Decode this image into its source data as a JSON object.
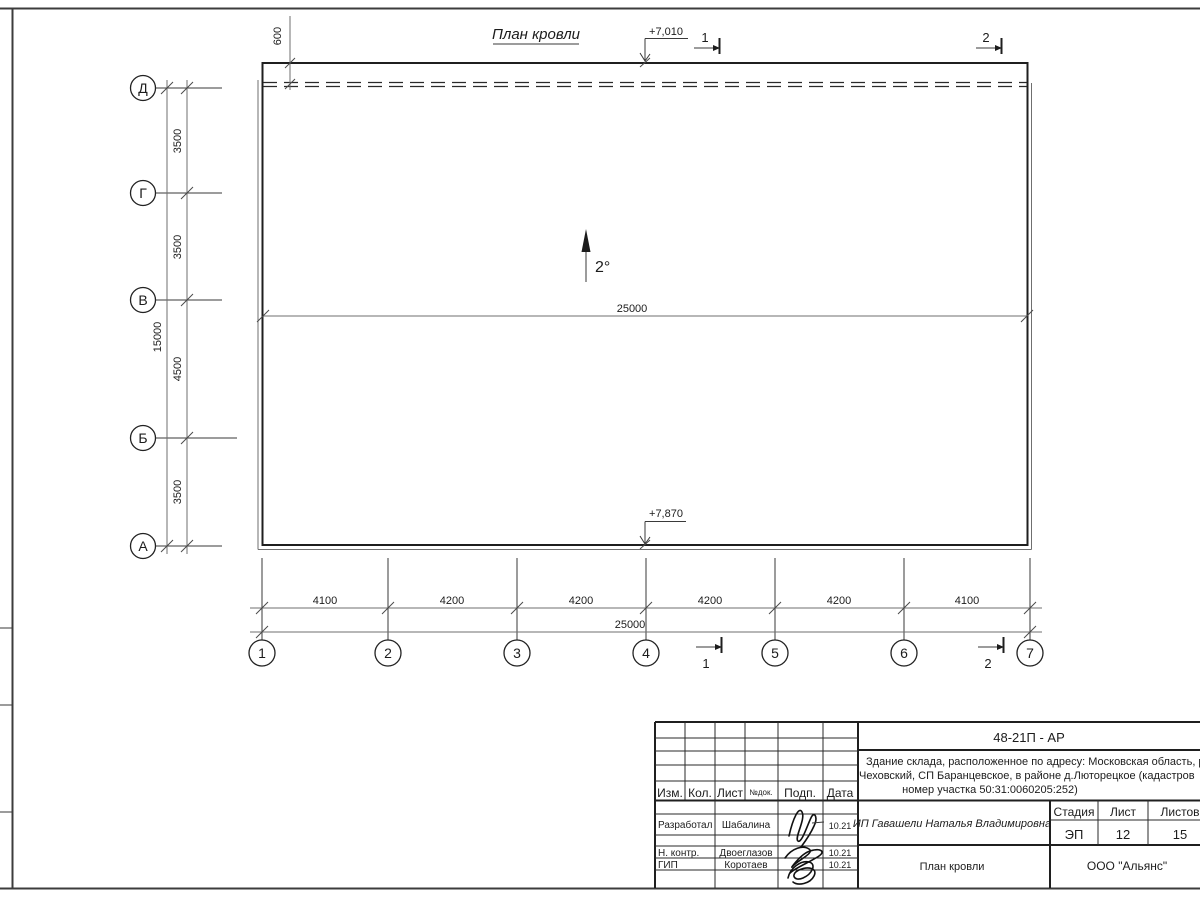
{
  "drawing": {
    "title": "План кровли",
    "slope_label": "2°",
    "elevation_top": "+7,010",
    "elevation_bottom": "+7,870",
    "ridge_length_label": "25000",
    "overhang_dim": "600"
  },
  "sections": {
    "one": "1",
    "two": "2"
  },
  "axes": {
    "vertical": [
      "Д",
      "Г",
      "В",
      "Б",
      "А"
    ],
    "horizontal": [
      "1",
      "2",
      "3",
      "4",
      "5",
      "6",
      "7"
    ]
  },
  "dims": {
    "vertical": [
      "3500",
      "3500",
      "4500",
      "3500"
    ],
    "vertical_total": "15000",
    "horizontal": [
      "4100",
      "4200",
      "4200",
      "4200",
      "4200",
      "4100"
    ],
    "horizontal_total": "25000"
  },
  "title_block": {
    "doc_code": "48-21П - АР",
    "address_line1": "Здание склада, расположенное по адресу: Московская область, р",
    "address_line2": "Чеховский, СП Баранцевское, в районе д.Люторецкое  (кадастров",
    "address_line3": "номер участка 50:31:0060205:252)",
    "client": "ИП Гавашели Наталья Владимировна",
    "sheet_title": "План кровли",
    "company": "ООО \"Альянс\"",
    "stage_label": "Стадия",
    "sheet_label": "Лист",
    "sheets_label": "Листов",
    "stage": "ЭП",
    "sheet": "12",
    "sheets": "15",
    "cols": {
      "izm": "Изм.",
      "kol": "Кол.",
      "list": "Лист",
      "ndok": "№док.",
      "podp": "Подп.",
      "data": "Дата"
    },
    "rows": [
      {
        "role": "Разработал",
        "name": "Шабалина",
        "date": "10.21"
      },
      {
        "role": "Н. контр.",
        "name": "Двоеглазов",
        "date": "10.21"
      },
      {
        "role": "ГИП",
        "name": "Коротаев",
        "date": "10.21"
      }
    ]
  }
}
